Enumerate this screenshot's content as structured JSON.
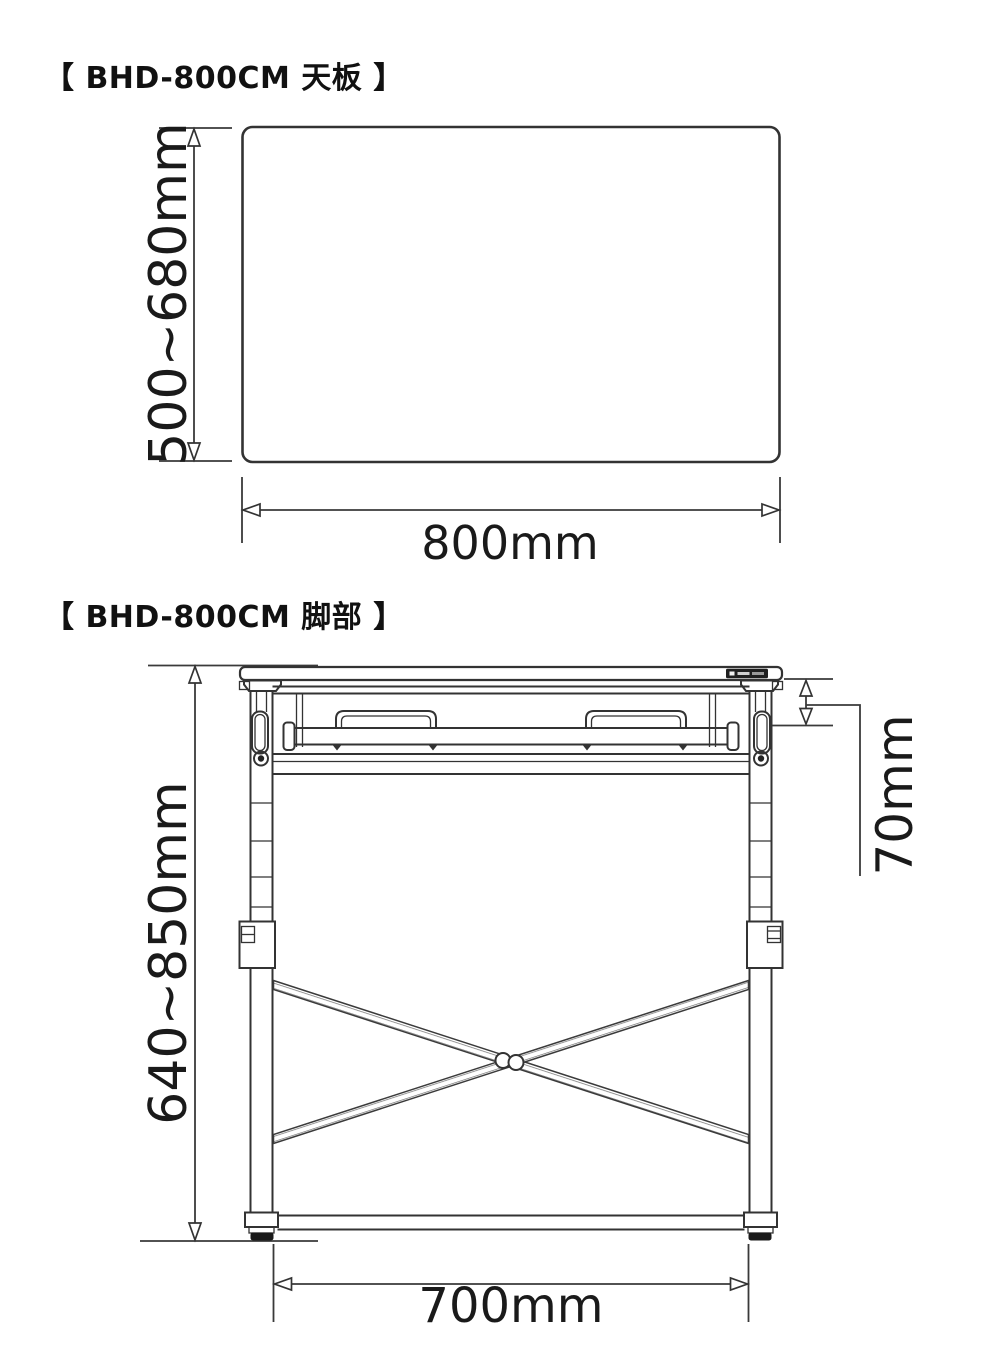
{
  "top_view": {
    "title": "【 BHD-800CM 天板 】",
    "height_label": "500~680mm",
    "width_label": "800mm"
  },
  "leg_view": {
    "title": "【 BHD-800CM 脚部 】",
    "height_label": "640~850mm",
    "clamp_offset_label": "70mm",
    "width_label": "700mm"
  },
  "colors": {
    "background": "#ffffff",
    "line": "#333333",
    "text": "#1a1a1a",
    "badge": "#1f1f1f"
  }
}
